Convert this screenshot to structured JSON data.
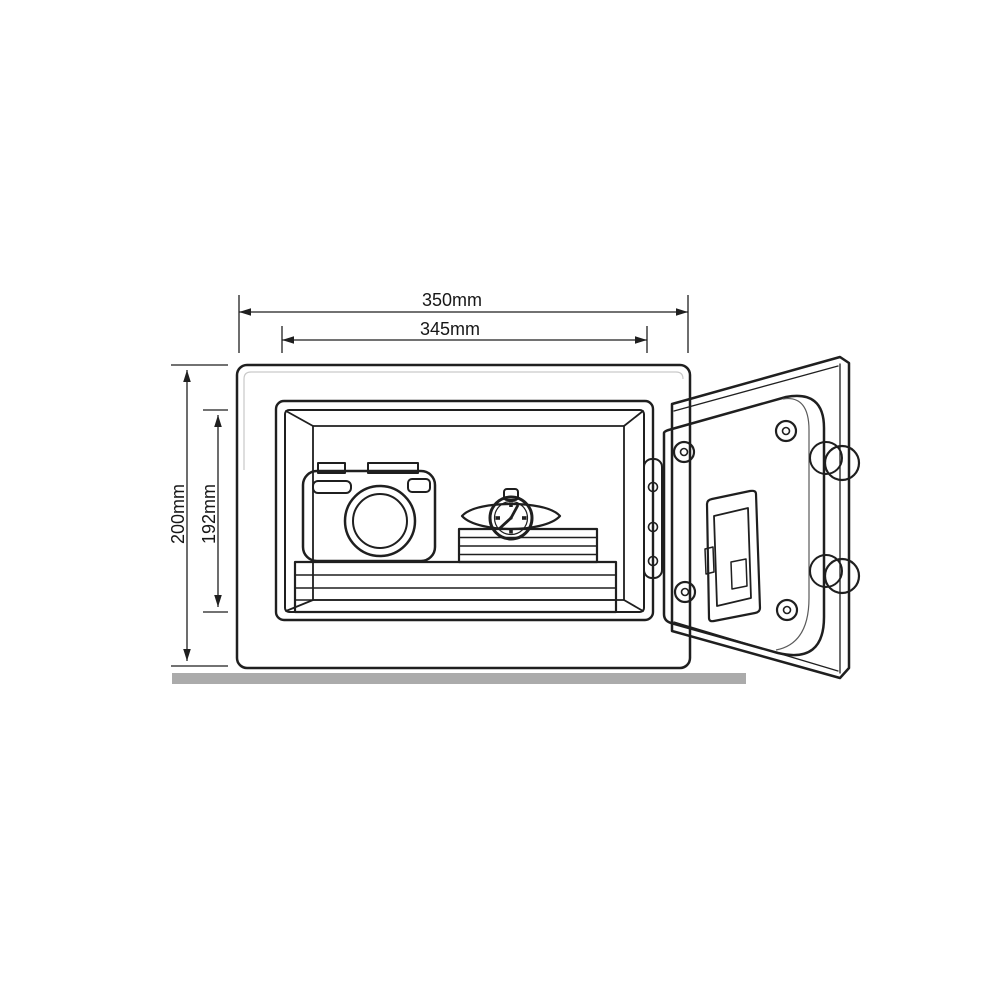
{
  "page": {
    "background": "#ffffff"
  },
  "dimensions": {
    "width_outer": {
      "label": "350mm",
      "orientation": "horizontal"
    },
    "width_inner": {
      "label": "345mm",
      "orientation": "horizontal"
    },
    "height_outer": {
      "label": "200mm",
      "orientation": "vertical"
    },
    "height_inner": {
      "label": "192mm",
      "orientation": "vertical"
    }
  },
  "objects": {
    "safe_body": "safe-body",
    "safe_interior": "safe-interior",
    "shelf": "shelf-stack-icon",
    "camera": "camera-icon",
    "wristwatch": "watch-icon",
    "books": "book-stack-icon",
    "door": "safe-door-open",
    "hinge": "hinge-strip",
    "locking_bolts": "locking-bolt-icon",
    "battery_compartment": "battery-compartment",
    "ground": "ground-line"
  },
  "colors": {
    "background": "#ffffff",
    "line": "#1f1f1f",
    "label": "#171717",
    "safe_body": "#f4f4f4",
    "rim": "#e2e2e2",
    "wall": "#a5a5a5",
    "back_wall": "#aeaeae",
    "shelf": "#ffffff",
    "tan": "#d2c5a0",
    "camera": "#ececec",
    "door_plate": "#d9d9d9",
    "door_panel": "#f8f8f8",
    "metal": "#e7e7e7",
    "ground": "#ababab"
  }
}
